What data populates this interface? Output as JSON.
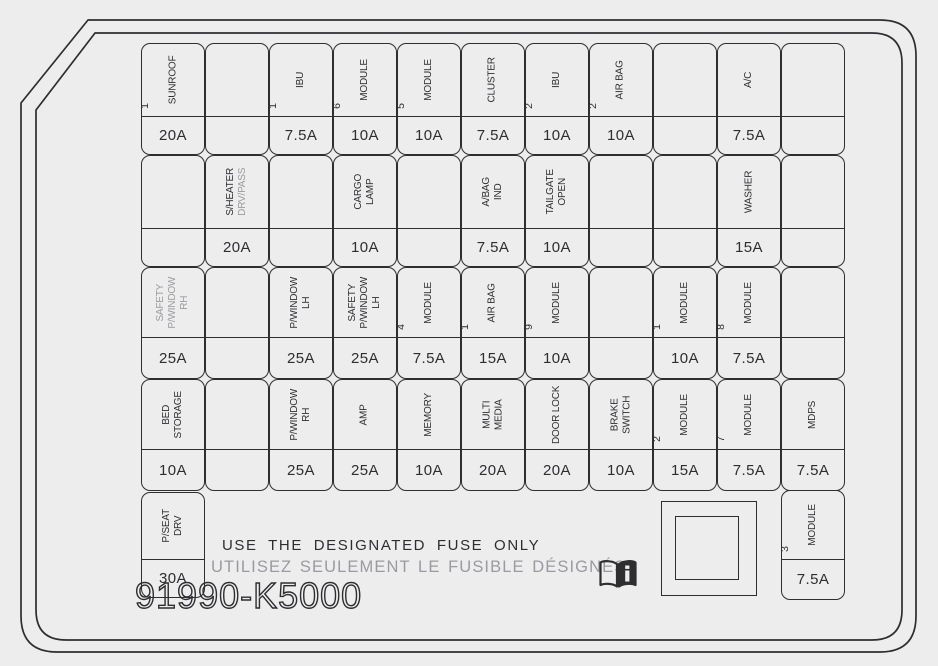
{
  "colors": {
    "background": "#ededee",
    "line": "#2e2e31",
    "text": "#2e2e31",
    "gray_text": "#9a9aa0"
  },
  "notes": {
    "english": "USE THE DESIGNATED FUSE ONLY",
    "french": "UTILISEZ SEULEMENT LE FUSIBLE DÉSIGNÉS"
  },
  "part_number": "91990-K5000",
  "icons": {
    "book": "owners-manual-book-icon",
    "relay": "relay-box"
  },
  "fuse_grid": {
    "rows": [
      {
        "cells": [
          {
            "num": "1",
            "label": "SUNROOF",
            "amp": "20A"
          },
          null,
          {
            "num": "1",
            "label": "IBU",
            "amp": "7.5A"
          },
          {
            "num": "6",
            "label": "MODULE",
            "amp": "10A"
          },
          {
            "num": "5",
            "label": "MODULE",
            "amp": "10A"
          },
          {
            "label": "CLUSTER",
            "amp": "7.5A"
          },
          {
            "num": "2",
            "label": "IBU",
            "amp": "10A"
          },
          {
            "num": "2",
            "label": "AIR BAG",
            "amp": "10A"
          },
          null,
          {
            "label": "A/C",
            "amp": "7.5A"
          },
          null
        ]
      },
      {
        "cells": [
          null,
          {
            "label": "S/HEATER",
            "gray_part": "DRV/PASS",
            "amp": "20A"
          },
          null,
          {
            "label": "CARGO\nLAMP",
            "amp": "10A"
          },
          null,
          {
            "label": "A/BAG\nIND",
            "amp": "7.5A"
          },
          {
            "label": "TAILGATE\nOPEN",
            "amp": "10A"
          },
          null,
          null,
          {
            "label": "WASHER",
            "amp": "15A"
          },
          null
        ]
      },
      {
        "cells": [
          {
            "label": "SAFETY\nP/WINDOW\nRH",
            "gray": true,
            "amp": "25A"
          },
          null,
          {
            "label": "P/WINDOW\nLH",
            "amp": "25A"
          },
          {
            "label": "SAFETY\nP/WINDOW\nLH",
            "amp": "25A"
          },
          {
            "num": "4",
            "label": "MODULE",
            "amp": "7.5A"
          },
          {
            "num": "1",
            "label": "AIR BAG",
            "amp": "15A"
          },
          {
            "num": "9",
            "label": "MODULE",
            "amp": "10A"
          },
          null,
          {
            "num": "1",
            "label": "MODULE",
            "amp": "10A"
          },
          {
            "num": "8",
            "label": "MODULE",
            "amp": "7.5A"
          },
          null
        ]
      },
      {
        "cells": [
          {
            "label": "BED\nSTORAGE",
            "amp": "10A"
          },
          null,
          {
            "label": "P/WINDOW\nRH",
            "amp": "25A"
          },
          {
            "label": "AMP",
            "amp": "25A"
          },
          {
            "label": "MEMORY",
            "amp": "10A"
          },
          {
            "label": "MULTI\nMEDIA",
            "amp": "20A"
          },
          {
            "label": "DOOR LOCK",
            "amp": "20A"
          },
          {
            "label": "BRAKE\nSWITCH",
            "amp": "10A"
          },
          {
            "num": "2",
            "label": "MODULE",
            "amp": "15A"
          },
          {
            "num": "7",
            "label": "MODULE",
            "amp": "7.5A"
          },
          {
            "label": "MDPS",
            "amp": "7.5A"
          }
        ]
      },
      {
        "cells": [
          {
            "label": "P/SEAT\nDRV",
            "amp": "30A"
          },
          null,
          null,
          null,
          null,
          null,
          null,
          null,
          null,
          null,
          {
            "num": "3",
            "label": "MODULE",
            "amp": "7.5A"
          }
        ]
      }
    ]
  }
}
